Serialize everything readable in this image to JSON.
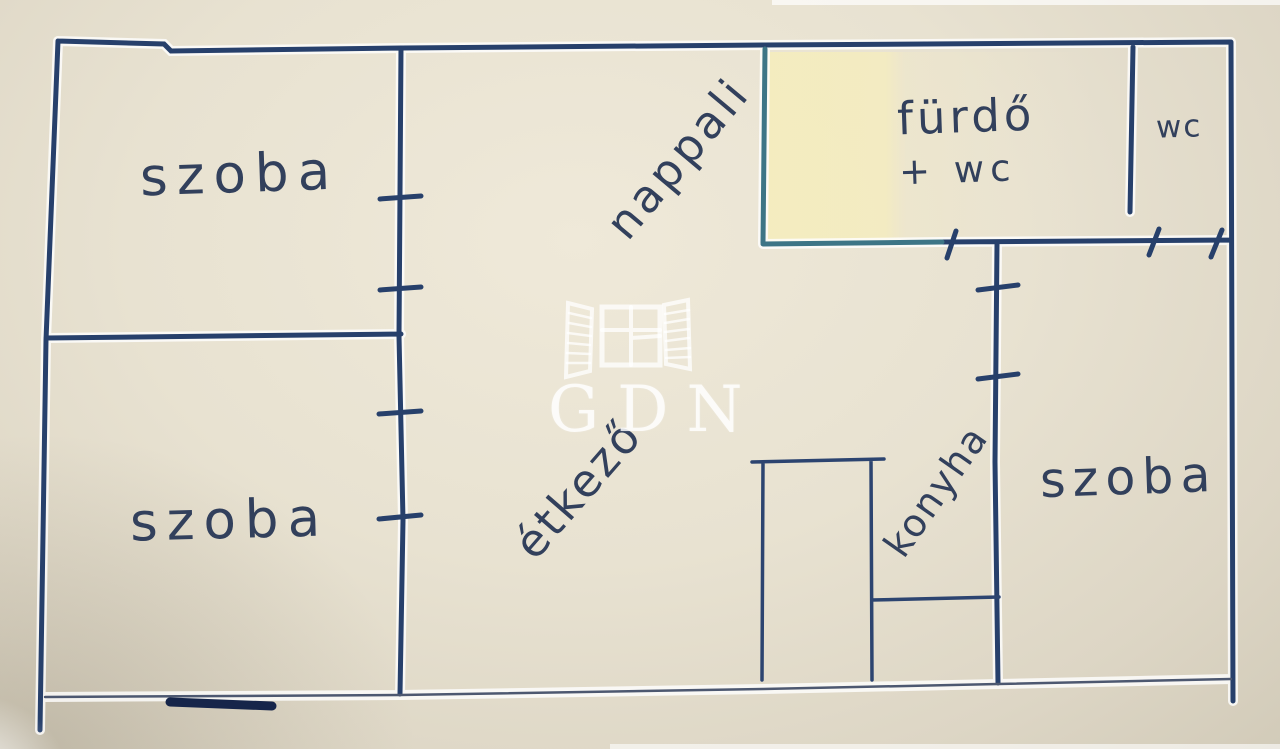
{
  "title": "hand-drawn apartment floor plan",
  "watermark": {
    "text": "GDN",
    "icon": "window-shutters-icon"
  },
  "rooms": {
    "room_top_left": {
      "label": "szoba"
    },
    "room_bottom_left": {
      "label": "szoba"
    },
    "living_room": {
      "label": "nappali"
    },
    "bathroom": {
      "label": "fürdő",
      "label_line2": "+ wc"
    },
    "wc": {
      "label": "wc"
    },
    "dining": {
      "label": "étkező"
    },
    "kitchen": {
      "label": "konyha"
    },
    "room_right": {
      "label": "szoba"
    }
  },
  "colors": {
    "paper": "#e8e2d1",
    "ink_navy": "#27406b",
    "ink_teal": "#3d7586",
    "handwriting": "#32405c",
    "highlight_yellow": "#f2eac2",
    "watermark_white": "rgba(255,255,255,0.8)"
  }
}
